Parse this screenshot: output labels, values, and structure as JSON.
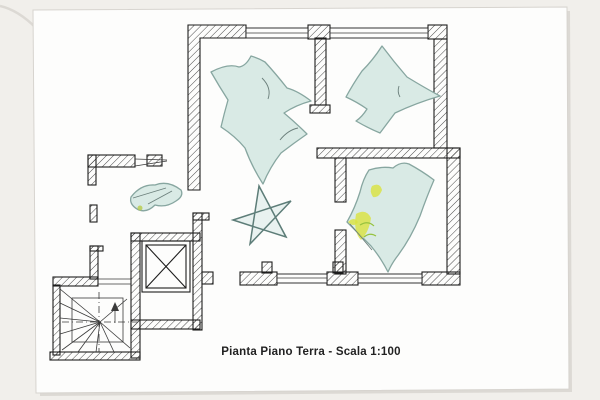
{
  "page": {
    "caption": "Pianta Piano Terra - Scala 1:100",
    "drawing_title": "Pianta Piano Terra",
    "scale": "1:100"
  },
  "colors": {
    "background": "#f1efeb",
    "paper": "#fdfdfc",
    "paper-edge": "#d7d4cf",
    "paper-shadow": "#dcd9d4",
    "ink": "#1d1d1d",
    "pencil": "#6b7f7b",
    "wash-fill": "#d9eae5",
    "wash-outline": "#87a6a0",
    "accent-yellow": "#d9e23f",
    "accent-green": "#96c23f"
  }
}
